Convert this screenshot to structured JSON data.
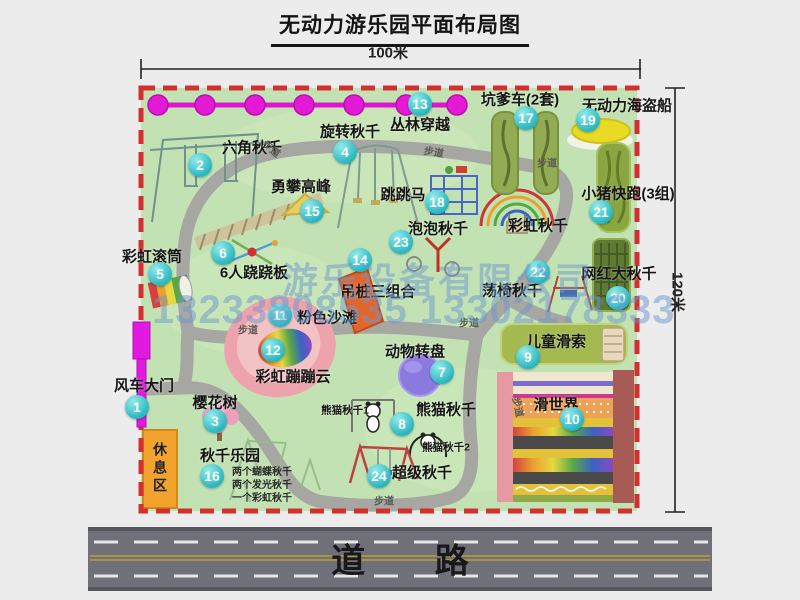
{
  "title": "无动力游乐园平面布局图",
  "dimensions": {
    "width": "100米",
    "height": "120米"
  },
  "road": {
    "label": "道 路"
  },
  "watermark": {
    "company": "游乐设备有限公司",
    "phone": "13233808535 13302178333"
  },
  "map": {
    "walkway_label": "步道",
    "rest_area_label": "休息区",
    "rainbow_swing_label": "彩虹秋千",
    "attractions": [
      {
        "number": "1",
        "label": "风车大门"
      },
      {
        "number": "2",
        "label": "六角秋千"
      },
      {
        "number": "3",
        "label": "樱花树"
      },
      {
        "number": "4",
        "label": "旋转秋千"
      },
      {
        "number": "5",
        "label": "彩虹滚筒"
      },
      {
        "number": "6",
        "label": "6人跷跷板"
      },
      {
        "number": "7",
        "label": "动物转盘"
      },
      {
        "number": "8",
        "label": "熊猫秋千",
        "sub1": "熊猫秋千1",
        "sub2": "熊猫秋千2"
      },
      {
        "number": "9",
        "label": "儿童滑索"
      },
      {
        "number": "10",
        "label": "滑世界"
      },
      {
        "number": "11",
        "label": "粉色沙滩"
      },
      {
        "number": "12",
        "label": "彩虹蹦蹦云"
      },
      {
        "number": "13",
        "label": "丛林穿越"
      },
      {
        "number": "14",
        "label": "吊桩三组合"
      },
      {
        "number": "15",
        "label": "勇攀高峰"
      },
      {
        "number": "16",
        "label": "秋千乐园",
        "details": [
          "两个蝴蝶秋千",
          "两个发光秋千",
          "一个彩虹秋千"
        ]
      },
      {
        "number": "17",
        "label": "坑爹车(2套)"
      },
      {
        "number": "18",
        "label": "跳跳马"
      },
      {
        "number": "19",
        "label": "无动力海盗船"
      },
      {
        "number": "20",
        "label": "网红大秋千"
      },
      {
        "number": "21",
        "label": "小猪快跑(3组)"
      },
      {
        "number": "22",
        "label": "荡椅秋千"
      },
      {
        "number": "23",
        "label": "泡泡秋千"
      },
      {
        "number": "24",
        "label": "超级秋千"
      }
    ]
  },
  "colors": {
    "map_green": "#c3e2b4",
    "path_gray": "#a6a6a2",
    "border_dash_red": "#d22f2f",
    "badge_teal": "#27b6c0",
    "zipline_magenta": "#e41ad6",
    "gate_magenta": "#e21ae0",
    "road_gray": "#70707a",
    "rest_area_orange": "#f1a32e"
  }
}
